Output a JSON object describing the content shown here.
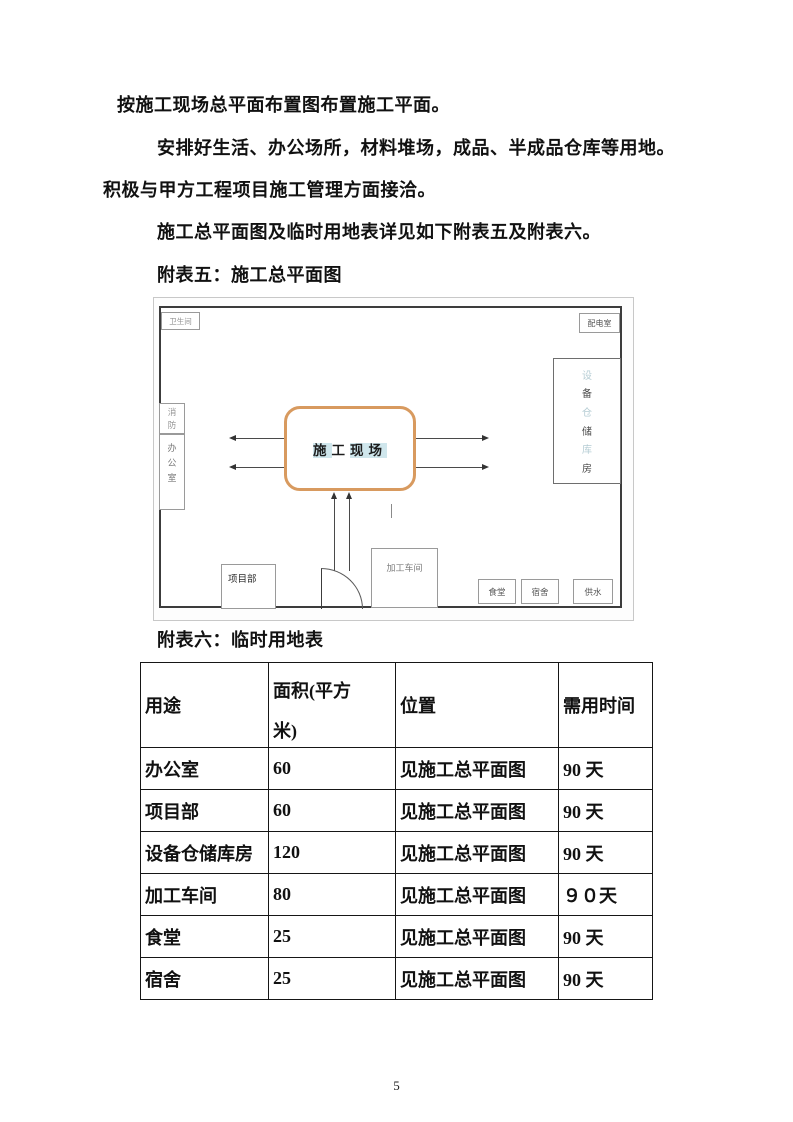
{
  "paragraphs": {
    "p1": "按施工现场总平面布置图布置施工平面。",
    "p2": "安排好生活、办公场所，材料堆场，成品、半成品仓库等用地。",
    "p3": "积极与甲方工程项目施工管理方面接洽。",
    "p4": "施工总平面图及临时用地表详见如下附表五及附表六。"
  },
  "figure": {
    "title": "附表五：施工总平面图",
    "site_label_chars": [
      "施",
      "工",
      "现",
      "场"
    ],
    "accent_border_color": "#d89a5f",
    "highlight_color": "#cfe6ec",
    "boxes": {
      "toilet": "卫生间",
      "power_room": "配电室",
      "storage_chars": [
        "设",
        "备",
        "仓",
        "储",
        "库",
        "房"
      ],
      "fire": "消\n防",
      "office": "办\n公\n室",
      "project_dept": "项目部",
      "workshop": "加工车间",
      "canteen": "食堂",
      "dormitory": "宿舍",
      "water_supply": "供水"
    }
  },
  "table": {
    "title": "附表六：临时用地表",
    "headers": [
      "用途",
      "面积(平方米)",
      "位置",
      "需用时间"
    ],
    "rows": [
      [
        "办公室",
        "60",
        "见施工总平面图",
        "90 天"
      ],
      [
        "项目部",
        "60",
        "见施工总平面图",
        "90 天"
      ],
      [
        "设备仓储库房",
        "120",
        "见施工总平面图",
        "90 天"
      ],
      [
        "加工车间",
        "80",
        "见施工总平面图",
        "９０天"
      ],
      [
        "食堂",
        "25",
        "见施工总平面图",
        "90 天"
      ],
      [
        "宿舍",
        "25",
        "见施工总平面图",
        "90 天"
      ]
    ]
  },
  "page_number": "5"
}
